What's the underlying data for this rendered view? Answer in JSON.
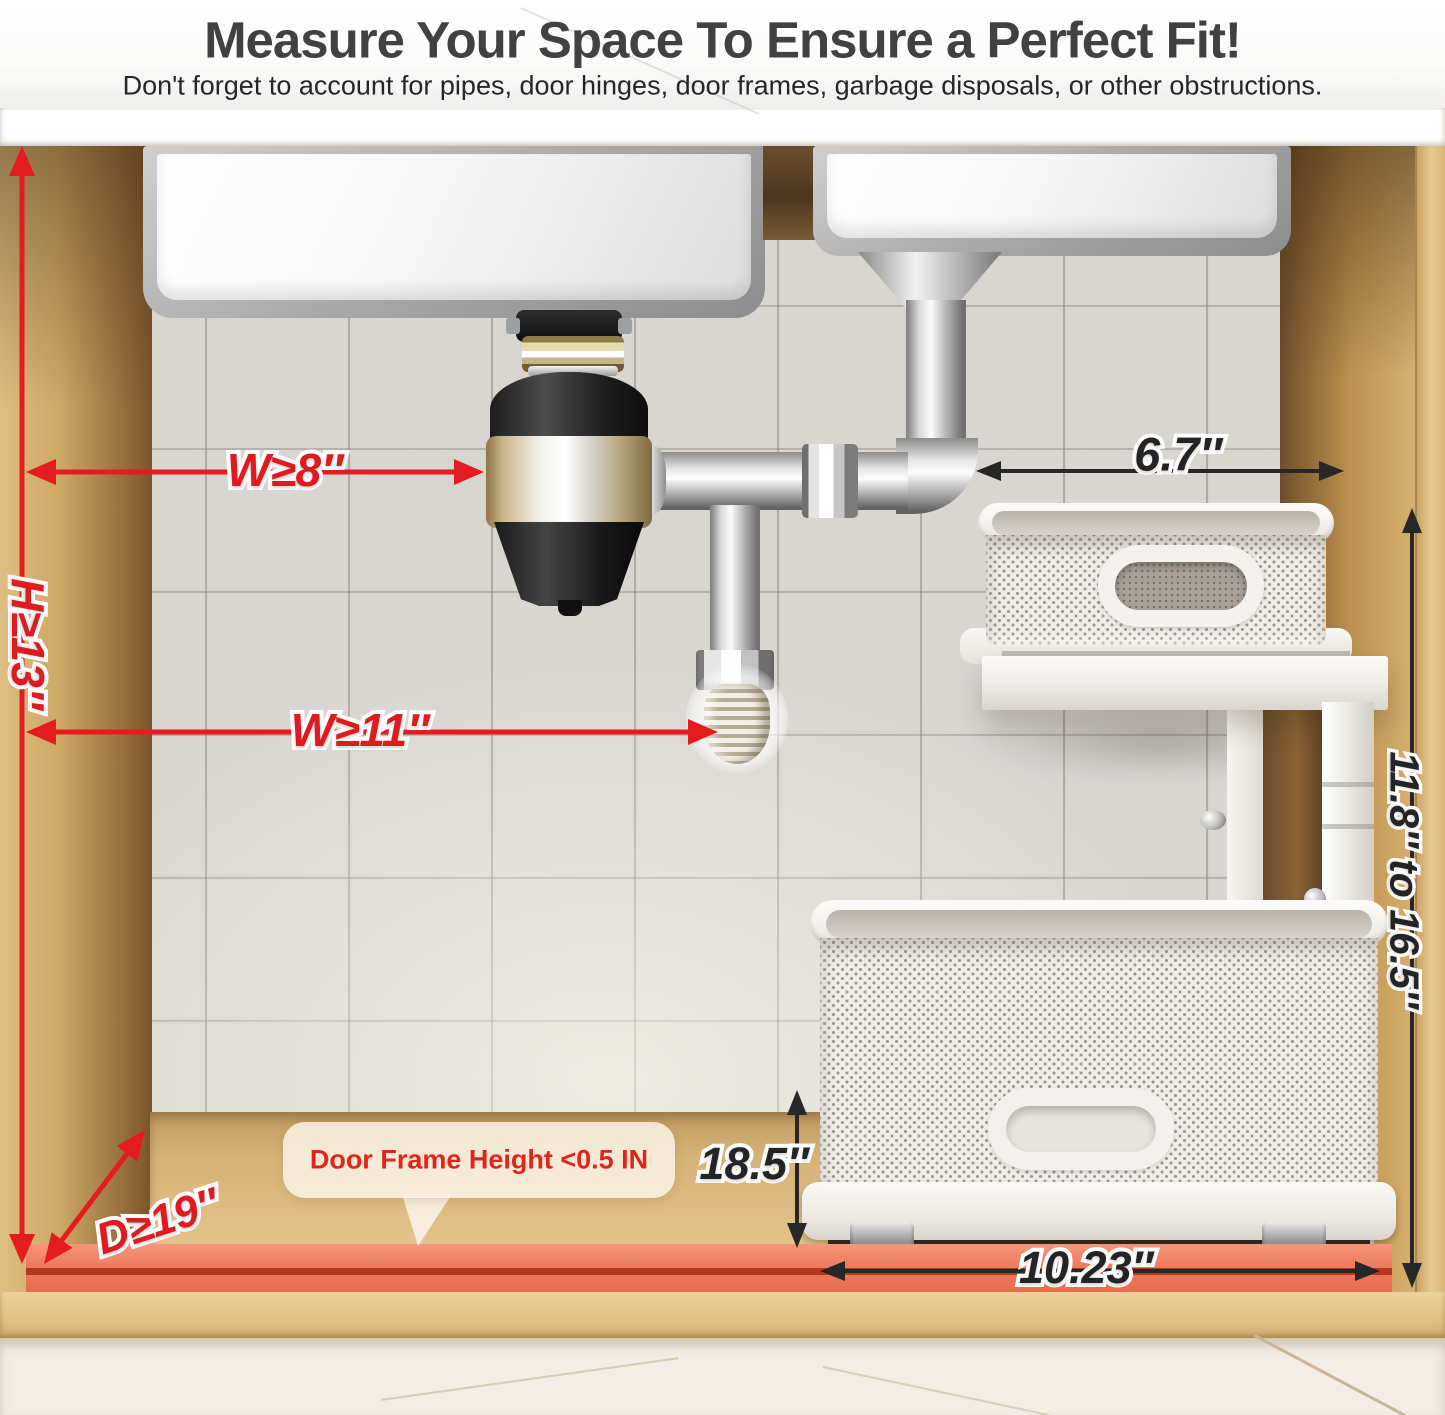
{
  "header": {
    "title": "Measure Your Space To Ensure a Perfect Fit!",
    "subtitle": "Don't forget to account for pipes, door hinges, door frames, garbage disposals, or other obstructions."
  },
  "annotations": {
    "width_min_disposal": "W≥8″",
    "height_min": "H≥13″",
    "width_min_drain": "W≥11″",
    "depth_min": "D≥19″",
    "top_tier_width": "6.7″",
    "adjustable_height": "11.8″ to 16.5″",
    "drawer_depth": "18.5″",
    "drawer_width": "10.23″",
    "door_frame_note": "Door Frame Height <0.5 IN"
  },
  "colors": {
    "annotation_red": "#e41b1f",
    "annotation_black": "#272727",
    "clearance_strip": "#ee7c5f",
    "wood": "#d9ba7c",
    "tile": "#d9d6d2"
  },
  "scene": {
    "objects": [
      "double sink",
      "garbage disposal",
      "drain pipes",
      "2-tier pull-out under-sink organizer",
      "cabinet"
    ]
  }
}
